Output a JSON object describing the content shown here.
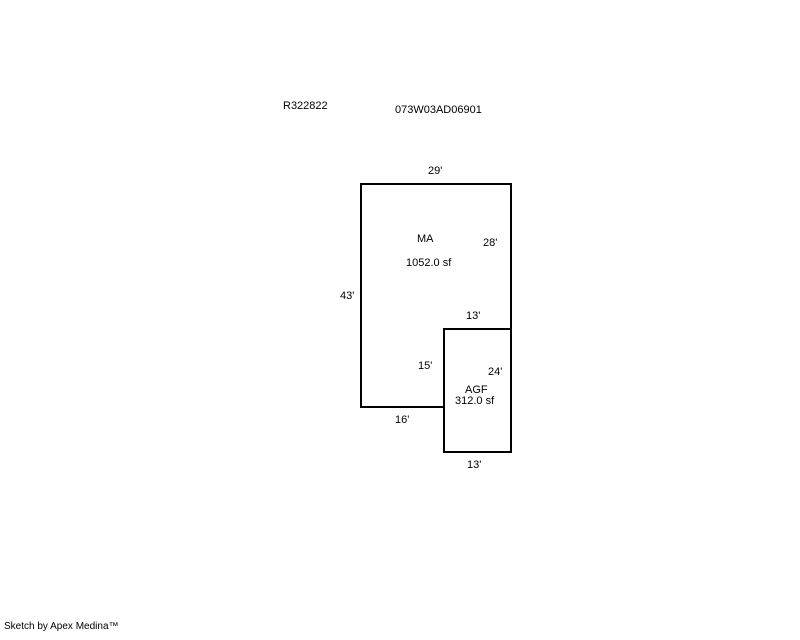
{
  "page": {
    "background": "#ffffff",
    "line_color": "#000000",
    "text_color": "#000000"
  },
  "header": {
    "account_number": "R322822",
    "parcel_number": "073W03AD06901"
  },
  "sketch": {
    "areas": [
      {
        "code": "MA",
        "size": "1052.0 sf"
      },
      {
        "code": "AGF",
        "size": "312.0 sf"
      }
    ],
    "dimensions": {
      "ma_top": "29'",
      "ma_right": "28'",
      "ma_left": "43'",
      "notch_top": "13'",
      "notch_side": "15'",
      "ma_bottom": "16'",
      "agf_right": "24'",
      "agf_bottom": "13'"
    }
  },
  "footer": {
    "credit": "Sketch by Apex Medina™"
  }
}
